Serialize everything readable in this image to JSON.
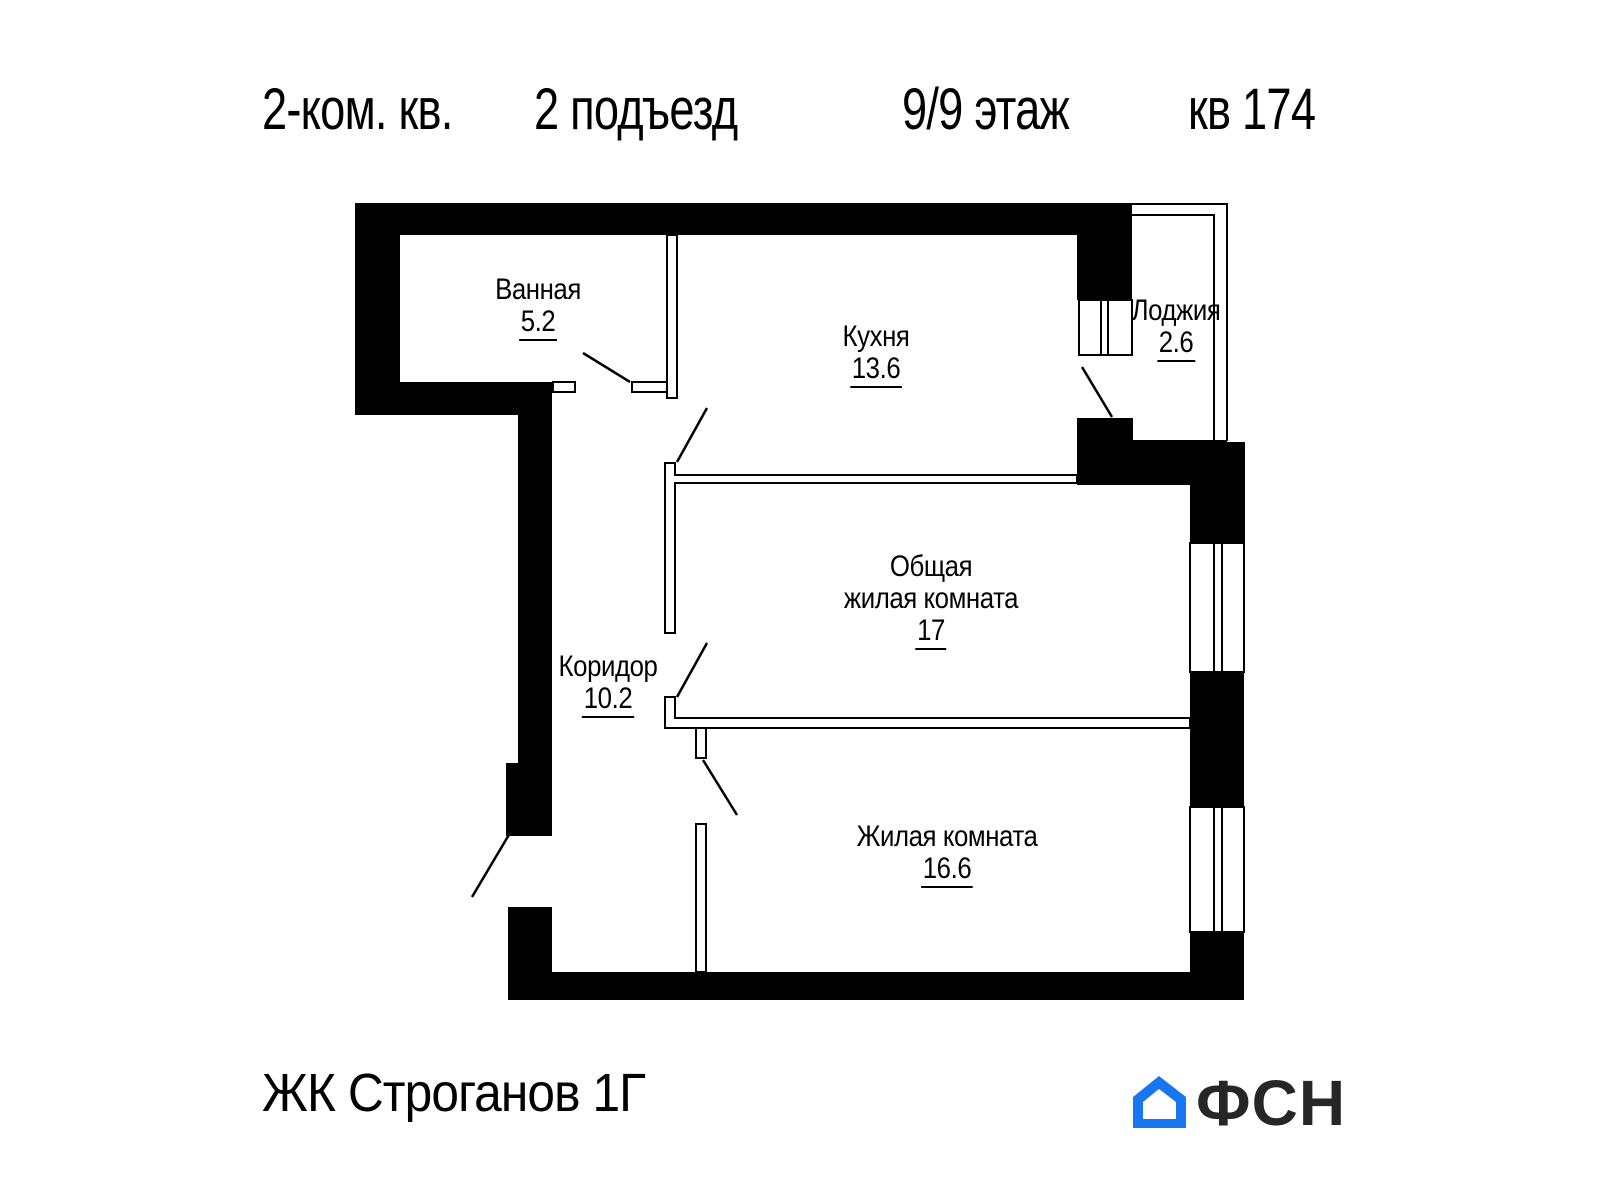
{
  "header": {
    "apartment_type": "2-ком. кв.",
    "entrance": "2 подъезд",
    "floor": "9/9 этаж",
    "apartment_number": "кв 174"
  },
  "rooms": {
    "bathroom": {
      "name": "Ванная",
      "area": "5.2"
    },
    "kitchen": {
      "name": "Кухня",
      "area": "13.6"
    },
    "loggia": {
      "name": "Лоджия",
      "area": "2.6"
    },
    "living_main": {
      "name_line1": "Общая",
      "name_line2": "жилая комната",
      "area": "17"
    },
    "corridor": {
      "name": "Коридор",
      "area": "10.2"
    },
    "living_second": {
      "name": "Жилая комната",
      "area": "16.6"
    }
  },
  "footer": {
    "complex_name": "ЖК Строганов 1Г",
    "logo_text": "ФСН"
  },
  "colors": {
    "walls": "#000000",
    "logo_blue": "#1877f0",
    "logo_text_color": "#262626"
  }
}
